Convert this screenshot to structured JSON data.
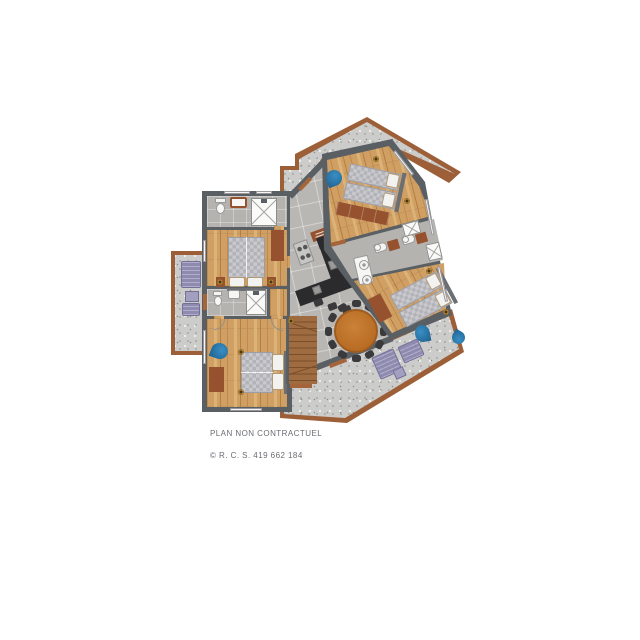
{
  "footer": {
    "disclaimer": "PLAN NON CONTRACTUEL",
    "registration": "© R. C. S. 419 662 184"
  },
  "palette": {
    "wall": "#5a5f64",
    "wood": "#cf9f63",
    "tile": "#b9b7b3",
    "bathfloor": "#b5b3af",
    "terrace": "#cccccb",
    "rim": "#9d5f37",
    "brown": "#96522f",
    "orange": "#c1762b",
    "seat": "#3a3a3c",
    "counter": "#2b2b2d",
    "duvet": "#c9c9cd",
    "pillowc": "#f2f2f0",
    "blue": "#2272aa",
    "purple": "#8f8bb0",
    "stair": "#9e6c40",
    "brass": "#b58938",
    "textgray": "#686c71",
    "headboard": "#6b6e72"
  }
}
